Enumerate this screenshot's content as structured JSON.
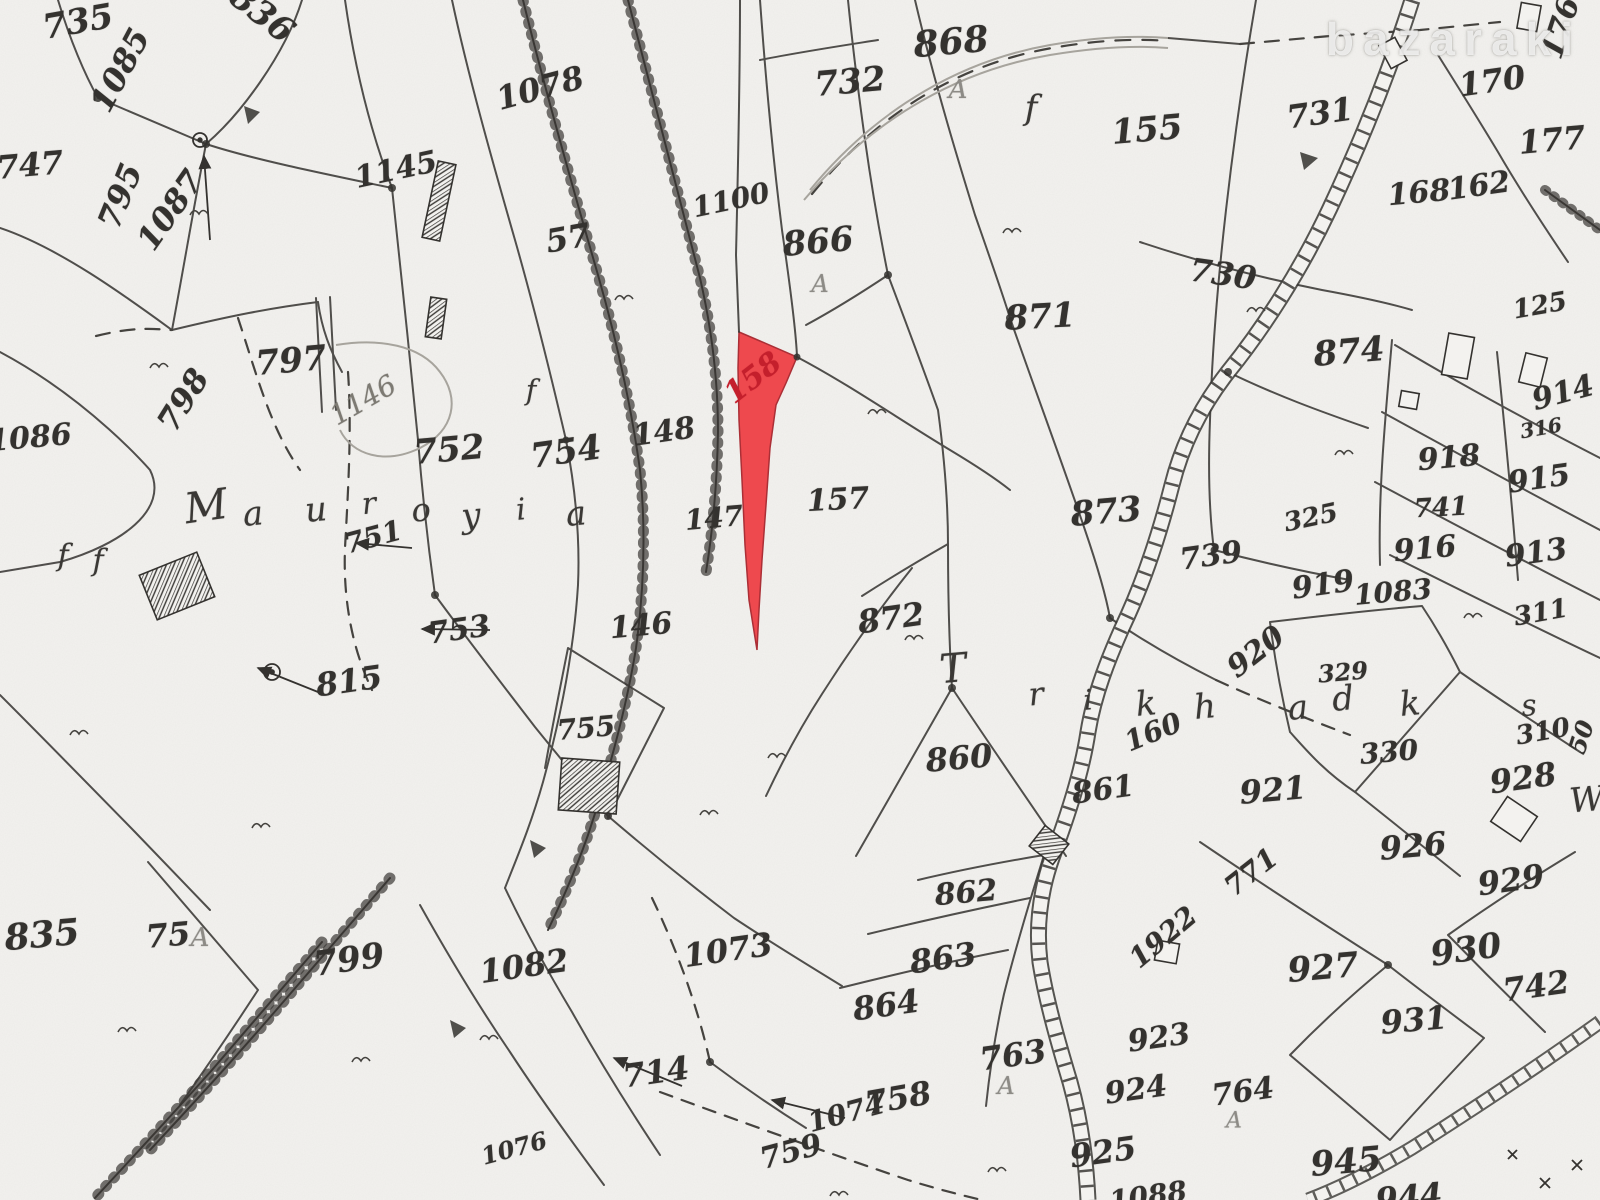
{
  "watermark": {
    "text": "bazaraki"
  },
  "map": {
    "ink": "#34322f",
    "paper": "#f3f2ef",
    "highlighted_parcel": {
      "number": "158",
      "fill": "#ee4146",
      "label_color": "#c41f2c"
    },
    "place_names": [
      {
        "text": "Mauroyia"
      },
      {
        "text": "Trikhadka"
      }
    ],
    "labels": [
      {
        "t": "735",
        "x": 78,
        "y": 22,
        "r": -10,
        "s": 34
      },
      {
        "t": "836",
        "x": 262,
        "y": 14,
        "r": 38,
        "s": 34
      },
      {
        "t": "1085",
        "x": 120,
        "y": 70,
        "r": -62,
        "s": 32
      },
      {
        "t": "747",
        "x": 30,
        "y": 165,
        "r": -5,
        "s": 32
      },
      {
        "t": "795",
        "x": 120,
        "y": 196,
        "r": -68,
        "s": 32
      },
      {
        "t": "1087",
        "x": 170,
        "y": 210,
        "r": -55,
        "s": 32
      },
      {
        "t": "1145",
        "x": 396,
        "y": 170,
        "r": -12,
        "s": 30
      },
      {
        "t": "1078",
        "x": 540,
        "y": 88,
        "r": -15,
        "s": 32
      },
      {
        "t": "57",
        "x": 568,
        "y": 238,
        "r": -10,
        "s": 32
      },
      {
        "t": "1100",
        "x": 731,
        "y": 200,
        "r": -12,
        "s": 28
      },
      {
        "t": "732",
        "x": 850,
        "y": 82,
        "r": -5,
        "s": 34
      },
      {
        "t": "868",
        "x": 951,
        "y": 42,
        "r": -5,
        "s": 36
      },
      {
        "t": "A",
        "x": 958,
        "y": 90,
        "r": 0,
        "s": 26,
        "c": "gray"
      },
      {
        "t": "155",
        "x": 1147,
        "y": 130,
        "r": -5,
        "s": 34
      },
      {
        "t": "866",
        "x": 818,
        "y": 242,
        "r": -5,
        "s": 34
      },
      {
        "t": "A",
        "x": 820,
        "y": 284,
        "r": 0,
        "s": 24,
        "c": "gray"
      },
      {
        "t": "871",
        "x": 1040,
        "y": 317,
        "r": -3,
        "s": 34
      },
      {
        "t": "731",
        "x": 1320,
        "y": 113,
        "r": -8,
        "s": 32
      },
      {
        "t": "170",
        "x": 1492,
        "y": 81,
        "r": -8,
        "s": 32
      },
      {
        "t": "176",
        "x": 1561,
        "y": 28,
        "r": -72,
        "s": 30
      },
      {
        "t": "177",
        "x": 1552,
        "y": 140,
        "r": -5,
        "s": 32
      },
      {
        "t": "168",
        "x": 1419,
        "y": 193,
        "r": -5,
        "s": 30
      },
      {
        "t": "162",
        "x": 1479,
        "y": 186,
        "r": -8,
        "s": 30
      },
      {
        "t": "730",
        "x": 1223,
        "y": 274,
        "r": 8,
        "s": 32
      },
      {
        "t": "125",
        "x": 1540,
        "y": 306,
        "r": -10,
        "s": 26
      },
      {
        "t": "874",
        "x": 1349,
        "y": 352,
        "r": -5,
        "s": 34
      },
      {
        "t": "914",
        "x": 1563,
        "y": 393,
        "r": -15,
        "s": 30
      },
      {
        "t": "316",
        "x": 1541,
        "y": 428,
        "r": -10,
        "s": 20
      },
      {
        "t": "918",
        "x": 1449,
        "y": 458,
        "r": -5,
        "s": 30
      },
      {
        "t": "915",
        "x": 1539,
        "y": 479,
        "r": -8,
        "s": 30
      },
      {
        "t": "741",
        "x": 1441,
        "y": 508,
        "r": -3,
        "s": 26
      },
      {
        "t": "916",
        "x": 1425,
        "y": 549,
        "r": -5,
        "s": 30
      },
      {
        "t": "913",
        "x": 1536,
        "y": 553,
        "r": -8,
        "s": 30
      },
      {
        "t": "325",
        "x": 1311,
        "y": 518,
        "r": -12,
        "s": 26
      },
      {
        "t": "739",
        "x": 1211,
        "y": 556,
        "r": -8,
        "s": 30
      },
      {
        "t": "919",
        "x": 1323,
        "y": 585,
        "r": -8,
        "s": 30
      },
      {
        "t": "1083",
        "x": 1393,
        "y": 592,
        "r": -5,
        "s": 28
      },
      {
        "t": "311",
        "x": 1541,
        "y": 613,
        "r": -10,
        "s": 26
      },
      {
        "t": "752",
        "x": 449,
        "y": 450,
        "r": -5,
        "s": 34
      },
      {
        "t": "754",
        "x": 566,
        "y": 452,
        "r": -8,
        "s": 34
      },
      {
        "t": "148",
        "x": 664,
        "y": 432,
        "r": -8,
        "s": 30
      },
      {
        "t": "147",
        "x": 714,
        "y": 518,
        "r": -5,
        "s": 28
      },
      {
        "t": "157",
        "x": 838,
        "y": 500,
        "r": -3,
        "s": 30
      },
      {
        "t": "158",
        "x": 753,
        "y": 378,
        "r": -38,
        "s": 30,
        "c": "red"
      },
      {
        "t": "873",
        "x": 1106,
        "y": 512,
        "r": -5,
        "s": 34
      },
      {
        "t": "1146",
        "x": 363,
        "y": 400,
        "r": -30,
        "s": 28,
        "c": "faint"
      },
      {
        "t": "751",
        "x": 373,
        "y": 537,
        "r": -15,
        "s": 28
      },
      {
        "t": "797",
        "x": 291,
        "y": 361,
        "r": -5,
        "s": 34
      },
      {
        "t": "798",
        "x": 183,
        "y": 400,
        "r": -58,
        "s": 32
      },
      {
        "t": "1086",
        "x": 30,
        "y": 438,
        "r": -5,
        "s": 30
      },
      {
        "t": "753",
        "x": 459,
        "y": 630,
        "r": -8,
        "s": 30
      },
      {
        "t": "146",
        "x": 641,
        "y": 626,
        "r": -5,
        "s": 30
      },
      {
        "t": "755",
        "x": 586,
        "y": 728,
        "r": -5,
        "s": 28
      },
      {
        "t": "815",
        "x": 349,
        "y": 681,
        "r": -8,
        "s": 32
      },
      {
        "t": "872",
        "x": 891,
        "y": 618,
        "r": -8,
        "s": 32
      },
      {
        "t": "860",
        "x": 959,
        "y": 758,
        "r": -5,
        "s": 32
      },
      {
        "t": "861",
        "x": 1103,
        "y": 790,
        "r": -8,
        "s": 30
      },
      {
        "t": "160",
        "x": 1153,
        "y": 732,
        "r": -22,
        "s": 28
      },
      {
        "t": "920",
        "x": 1256,
        "y": 652,
        "r": -38,
        "s": 30
      },
      {
        "t": "329",
        "x": 1343,
        "y": 672,
        "r": -5,
        "s": 24
      },
      {
        "t": "330",
        "x": 1389,
        "y": 752,
        "r": -5,
        "s": 28
      },
      {
        "t": "921",
        "x": 1273,
        "y": 790,
        "r": -5,
        "s": 32
      },
      {
        "t": "310",
        "x": 1543,
        "y": 732,
        "r": -10,
        "s": 26
      },
      {
        "t": "s",
        "x": 1529,
        "y": 706,
        "r": -5,
        "s": 30,
        "c": "script"
      },
      {
        "t": "50",
        "x": 1581,
        "y": 737,
        "r": -72,
        "s": 24
      },
      {
        "t": "928",
        "x": 1523,
        "y": 778,
        "r": -8,
        "s": 32
      },
      {
        "t": "W",
        "x": 1587,
        "y": 800,
        "r": -5,
        "s": 34,
        "c": "script"
      },
      {
        "t": "926",
        "x": 1413,
        "y": 846,
        "r": -5,
        "s": 32
      },
      {
        "t": "929",
        "x": 1511,
        "y": 880,
        "r": -8,
        "s": 32
      },
      {
        "t": "771",
        "x": 1251,
        "y": 872,
        "r": -38,
        "s": 28
      },
      {
        "t": "1922",
        "x": 1163,
        "y": 937,
        "r": -40,
        "s": 28
      },
      {
        "t": "862",
        "x": 966,
        "y": 893,
        "r": -5,
        "s": 30
      },
      {
        "t": "863",
        "x": 943,
        "y": 958,
        "r": -8,
        "s": 32
      },
      {
        "t": "864",
        "x": 886,
        "y": 1005,
        "r": -8,
        "s": 32
      },
      {
        "t": "763",
        "x": 1013,
        "y": 1055,
        "r": -8,
        "s": 32
      },
      {
        "t": "A",
        "x": 1006,
        "y": 1086,
        "r": 0,
        "s": 24,
        "c": "gray"
      },
      {
        "t": "758",
        "x": 898,
        "y": 1098,
        "r": -10,
        "s": 32
      },
      {
        "t": "1074",
        "x": 846,
        "y": 1113,
        "r": -15,
        "s": 28
      },
      {
        "t": "759",
        "x": 791,
        "y": 1152,
        "r": -15,
        "s": 30
      },
      {
        "t": "925",
        "x": 1103,
        "y": 1152,
        "r": -8,
        "s": 32
      },
      {
        "t": "924",
        "x": 1136,
        "y": 1090,
        "r": -8,
        "s": 30
      },
      {
        "t": "923",
        "x": 1159,
        "y": 1038,
        "r": -8,
        "s": 30
      },
      {
        "t": "927",
        "x": 1323,
        "y": 968,
        "r": -5,
        "s": 34
      },
      {
        "t": "930",
        "x": 1466,
        "y": 950,
        "r": -8,
        "s": 34
      },
      {
        "t": "742",
        "x": 1536,
        "y": 986,
        "r": -8,
        "s": 32
      },
      {
        "t": "931",
        "x": 1414,
        "y": 1020,
        "r": -5,
        "s": 32
      },
      {
        "t": "764",
        "x": 1243,
        "y": 1092,
        "r": -8,
        "s": 30
      },
      {
        "t": "A",
        "x": 1234,
        "y": 1121,
        "r": 0,
        "s": 22,
        "c": "gray"
      },
      {
        "t": "945",
        "x": 1346,
        "y": 1162,
        "r": -5,
        "s": 34
      },
      {
        "t": "944",
        "x": 1409,
        "y": 1197,
        "r": -5,
        "s": 32
      },
      {
        "t": "1088",
        "x": 1148,
        "y": 1196,
        "r": -8,
        "s": 28
      },
      {
        "t": "835",
        "x": 42,
        "y": 935,
        "r": -5,
        "s": 36
      },
      {
        "t": "75",
        "x": 168,
        "y": 935,
        "r": -5,
        "s": 32
      },
      {
        "t": "A",
        "x": 200,
        "y": 938,
        "r": 0,
        "s": 26,
        "c": "gray"
      },
      {
        "t": "799",
        "x": 349,
        "y": 960,
        "r": -8,
        "s": 34
      },
      {
        "t": "1082",
        "x": 524,
        "y": 966,
        "r": -8,
        "s": 32
      },
      {
        "t": "1073",
        "x": 728,
        "y": 950,
        "r": -8,
        "s": 32
      },
      {
        "t": "714",
        "x": 656,
        "y": 1072,
        "r": -8,
        "s": 32
      },
      {
        "t": "1076",
        "x": 514,
        "y": 1148,
        "r": -15,
        "s": 24
      },
      {
        "t": "f",
        "x": 63,
        "y": 556,
        "r": 0,
        "s": 30,
        "c": "script"
      },
      {
        "t": "f",
        "x": 98,
        "y": 561,
        "r": 0,
        "s": 30,
        "c": "script"
      },
      {
        "t": "f",
        "x": 531,
        "y": 390,
        "r": 0,
        "s": 28,
        "c": "script"
      },
      {
        "t": "f",
        "x": 1031,
        "y": 108,
        "r": 0,
        "s": 34,
        "c": "script"
      },
      {
        "t": "M",
        "x": 206,
        "y": 506,
        "r": -8,
        "s": 42,
        "c": "script"
      },
      {
        "t": "a",
        "x": 253,
        "y": 514,
        "r": -5,
        "s": 34,
        "c": "script"
      },
      {
        "t": "u",
        "x": 316,
        "y": 510,
        "r": -5,
        "s": 34,
        "c": "script"
      },
      {
        "t": "r",
        "x": 369,
        "y": 504,
        "r": -5,
        "s": 30,
        "c": "script"
      },
      {
        "t": "o",
        "x": 421,
        "y": 510,
        "r": -5,
        "s": 32,
        "c": "script"
      },
      {
        "t": "y",
        "x": 471,
        "y": 516,
        "r": -5,
        "s": 34,
        "c": "script"
      },
      {
        "t": "i",
        "x": 521,
        "y": 510,
        "r": -5,
        "s": 30,
        "c": "script"
      },
      {
        "t": "a",
        "x": 576,
        "y": 514,
        "r": -5,
        "s": 34,
        "c": "script"
      },
      {
        "t": "T",
        "x": 953,
        "y": 669,
        "r": -5,
        "s": 40,
        "c": "script"
      },
      {
        "t": "r",
        "x": 1036,
        "y": 694,
        "r": -5,
        "s": 32,
        "c": "script"
      },
      {
        "t": "i",
        "x": 1088,
        "y": 700,
        "r": -5,
        "s": 28,
        "c": "script"
      },
      {
        "t": "k",
        "x": 1146,
        "y": 704,
        "r": -5,
        "s": 34,
        "c": "script"
      },
      {
        "t": "h",
        "x": 1205,
        "y": 707,
        "r": -5,
        "s": 34,
        "c": "script"
      },
      {
        "t": "a",
        "x": 1298,
        "y": 708,
        "r": -5,
        "s": 34,
        "c": "script"
      },
      {
        "t": "d",
        "x": 1343,
        "y": 699,
        "r": -5,
        "s": 34,
        "c": "script"
      },
      {
        "t": "k",
        "x": 1410,
        "y": 704,
        "r": -5,
        "s": 34,
        "c": "script"
      }
    ]
  }
}
